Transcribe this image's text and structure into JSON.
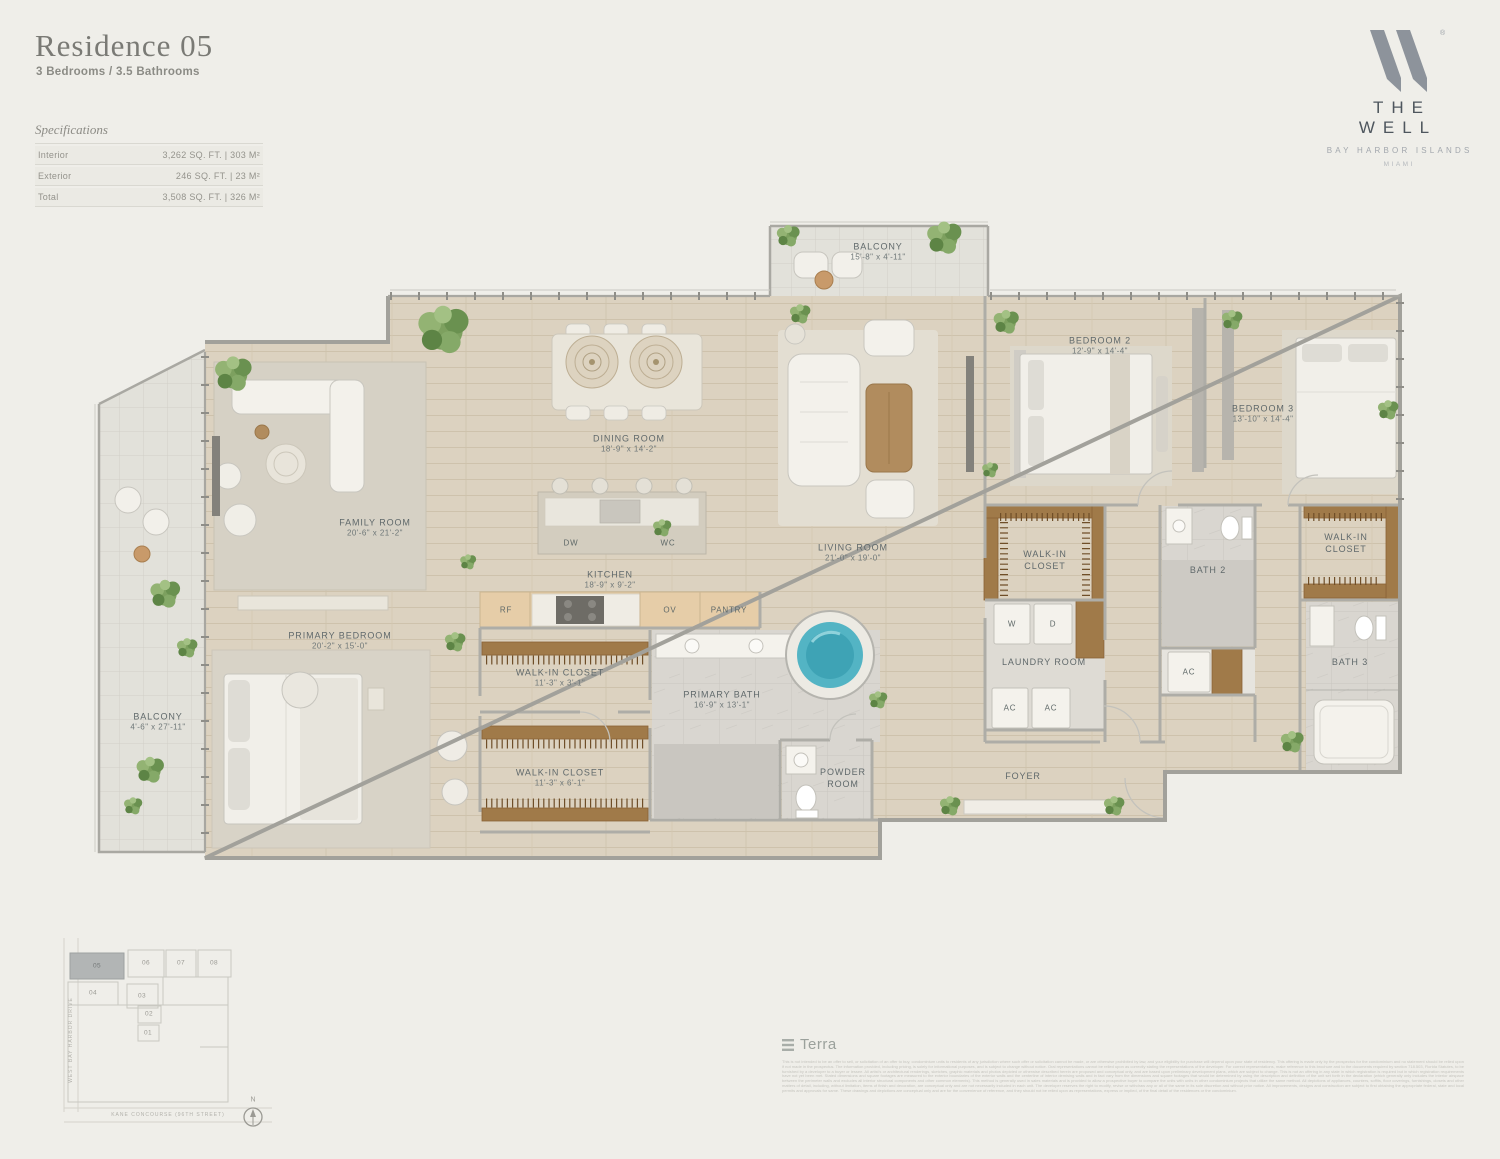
{
  "header": {
    "title": "Residence 05",
    "subtitle": "3 Bedrooms / 3.5 Bathrooms"
  },
  "specs": {
    "heading": "Specifications",
    "rows": [
      {
        "label": "Interior",
        "value": "3,262 SQ. FT.  |  303 M²"
      },
      {
        "label": "Exterior",
        "value": "246 SQ. FT.  |  23 M²"
      },
      {
        "label": "Total",
        "value": "3,508 SQ. FT.  |  326 M²"
      }
    ]
  },
  "brand": {
    "name": "THE WELL",
    "tagline": "BAY HARBOR ISLANDS",
    "city": "MIAMI",
    "registered": "®"
  },
  "rooms": {
    "balcony_top": {
      "name": "BALCONY",
      "dims": "15'-8\" x 4'-11\""
    },
    "dining": {
      "name": "DINING ROOM",
      "dims": "18'-9\" x 14'-2\""
    },
    "family": {
      "name": "FAMILY ROOM",
      "dims": "20'-6\" x 21'-2\""
    },
    "kitchen": {
      "name": "KITCHEN",
      "dims": "18'-9\" x 9'-2\""
    },
    "living": {
      "name": "LIVING ROOM",
      "dims": "21'-0\" x 19'-0\""
    },
    "bedroom2": {
      "name": "BEDROOM 2",
      "dims": "12'-9\" x 14'-4\""
    },
    "bedroom3": {
      "name": "BEDROOM 3",
      "dims": "13'-10\" x 14'-4\""
    },
    "primary_bedroom": {
      "name": "PRIMARY BEDROOM",
      "dims": "20'-2\" x 15'-0\""
    },
    "primary_bath": {
      "name": "PRIMARY BATH",
      "dims": "16'-9\" x 13'-1\""
    },
    "wic_a": {
      "name": "WALK-IN CLOSET",
      "dims": "11'-3\" x 3'-1\""
    },
    "wic_b": {
      "name": "WALK-IN CLOSET",
      "dims": "11'-3\" x 6'-1\""
    },
    "wic_bed2": {
      "name": "WALK-IN",
      "name2": "CLOSET"
    },
    "wic_bed3": {
      "name": "WALK-IN",
      "name2": "CLOSET"
    },
    "bath2": {
      "name": "BATH 2"
    },
    "bath3": {
      "name": "BATH 3"
    },
    "laundry": {
      "name": "LAUNDRY ROOM"
    },
    "powder": {
      "name": "POWDER",
      "name2": "ROOM"
    },
    "foyer": {
      "name": "FOYER"
    },
    "balcony_left": {
      "name": "BALCONY",
      "dims": "4'-6\" x 27'-11\""
    }
  },
  "appliances": {
    "dw": "DW",
    "wc": "WC",
    "rf": "RF",
    "ov": "OV",
    "pantry": "PANTRY",
    "w": "W",
    "d": "D",
    "ac": "AC"
  },
  "sitemap": {
    "units": [
      {
        "num": "05"
      },
      {
        "num": "06"
      },
      {
        "num": "07"
      },
      {
        "num": "08"
      },
      {
        "num": "04"
      },
      {
        "num": "03"
      },
      {
        "num": "02"
      },
      {
        "num": "01"
      }
    ],
    "street_left": "WEST BAY HARBOR DRIVE",
    "street_bottom": "KANE CONCOURSE (96TH STREET)",
    "compass_n": "N"
  },
  "footer": {
    "brand": "Terra",
    "disclaimer": "This is not intended to be an offer to sell, or solicitation of an offer to buy, condominium units to residents of any jurisdiction where such offer or solicitation cannot be made, or are otherwise prohibited by law, and your eligibility for purchase will depend upon your state of residency. This offering is made only by the prospectus for the condominium and no statement should be relied upon if not made in the prospectus. The information provided, including pricing, is solely for informational purposes, and is subject to change without notice. Oral representations cannot be relied upon as correctly stating the representations of the developer. For correct representations, make reference to this brochure and to the documents required by section 718.503, Florida Statutes, to be furnished by a developer to a buyer or lessee. All artist's or architectural renderings, sketches, graphic materials and photos depicted or otherwise described herein are proposed and conceptual only, and are based upon preliminary development plans, which are subject to change. This is not an offering in any state in which registration is required but in which registration requirements have not yet been met. Stated dimensions and square footages are measured to the exterior boundaries of the exterior walls and the centerline of interior demising walls and in fact vary from the dimensions and square footages that would be determined by using the description and definition of the unit set forth in the declaration (which generally only includes the interior airspace between the perimeter walls and excludes all interior structural components and other common elements). This method is generally used in sales materials and is provided to allow a prospective buyer to compare the units with units in other condominium projects that utilize the same method. All depictions of appliances, counters, soffits, floor coverings, furnishings, closets and other matters of detail, including, without limitation, items of finish and decoration, are conceptual only and are not necessarily included in each unit. The developer reserves the right to modify, revise or withdraw any or all of the same in its sole discretion and without prior notice. All improvements, designs and construction are subject to first obtaining the appropriate federal, state and local permits and approvals for same. These drawings and depictions are conceptual only and are for the convenience of reference, and they should not be relied upon as representations, express or implied, of the final detail of the residences or the condominium."
  }
}
